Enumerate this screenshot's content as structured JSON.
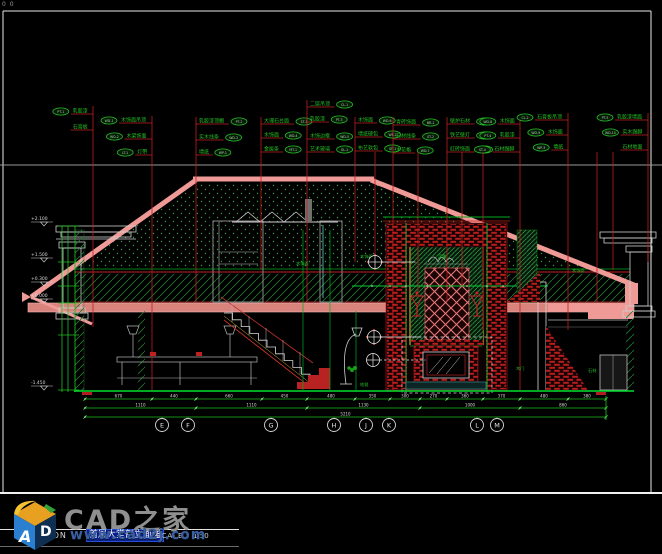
{
  "origin": "0 0",
  "colors": {
    "leader_red": "#c02020",
    "callout_green": "#25c025",
    "dim_green": "#20c020",
    "outline_pink": "#ef9a97",
    "ground_green": "#00e030",
    "white_line": "#e0e0e0"
  },
  "callouts": {
    "groups": [
      {
        "x": 93,
        "top": 106,
        "bottom": 327,
        "rows": [
          {
            "y": 112,
            "tag": "PT-1",
            "label": "乳胶漆",
            "side": "left"
          },
          {
            "y": 128,
            "tag": null,
            "label": "石膏板",
            "side": "left"
          }
        ]
      },
      {
        "x": 152,
        "top": 116,
        "bottom": 390,
        "rows": [
          {
            "y": 121,
            "tag": "WD-1",
            "label": "木饰面吊顶",
            "side": "left"
          },
          {
            "y": 137,
            "tag": "WD-2",
            "label": "木梁饰面",
            "side": "left"
          },
          {
            "y": 153,
            "tag": "LT-1",
            "label": "灯带",
            "side": "left"
          }
        ]
      },
      {
        "x": 196,
        "top": 117,
        "bottom": 302,
        "rows": [
          {
            "y": 122,
            "tag": "PT-2",
            "label": "乳胶漆顶棚",
            "side": "right"
          },
          {
            "y": 138,
            "tag": "WD-3",
            "label": "实木线条",
            "side": "right"
          },
          {
            "y": 153,
            "tag": "WP-1",
            "label": "墙纸",
            "side": "right"
          }
        ]
      },
      {
        "x": 261,
        "top": 117,
        "bottom": 270,
        "rows": [
          {
            "y": 122,
            "tag": "ST-1",
            "label": "大理石台面",
            "side": "right"
          },
          {
            "y": 136,
            "tag": "WD-4",
            "label": "木饰面",
            "side": "right"
          },
          {
            "y": 150,
            "tag": "MT-1",
            "label": "金属条",
            "side": "right"
          }
        ]
      },
      {
        "x": 307,
        "top": 100,
        "bottom": 302,
        "rows": [
          {
            "y": 105,
            "tag": "CL-1",
            "label": "二层吊顶",
            "side": "right"
          },
          {
            "y": 120,
            "tag": "PT-3",
            "label": "乳胶漆",
            "side": "right"
          },
          {
            "y": 137,
            "tag": "WD-5",
            "label": "木饰边框",
            "side": "right"
          },
          {
            "y": 150,
            "tag": "GL-1",
            "label": "艺术玻璃",
            "side": "right"
          }
        ]
      },
      {
        "x": 355,
        "top": 117,
        "bottom": 262,
        "rows": [
          {
            "y": 121,
            "tag": "WD-6",
            "label": "木饰面",
            "side": "right"
          },
          {
            "y": 135,
            "tag": "WP-2",
            "label": "墙纸硬包",
            "side": "right"
          },
          {
            "y": 149,
            "tag": "SF-1",
            "label": "布艺软包",
            "side": "right"
          }
        ]
      },
      {
        "x": 393,
        "top": 117,
        "bottom": 390,
        "rows": [
          {
            "y": 123,
            "tag": "BR-1",
            "label": "青砖饰面",
            "side": "right"
          },
          {
            "y": 137,
            "tag": "ST-2",
            "label": "石材线条",
            "side": "right"
          },
          {
            "y": 151,
            "tag": "WD-7",
            "label": "木花格",
            "side": "right"
          }
        ]
      },
      {
        "x": 447,
        "top": 117,
        "bottom": 302,
        "rows": [
          {
            "y": 122,
            "tag": "FP-1",
            "label": "壁炉石材",
            "side": "right"
          },
          {
            "y": 136,
            "tag": "MT-2",
            "label": "铁艺壁灯",
            "side": "right"
          },
          {
            "y": 150,
            "tag": "BR-2",
            "label": "红砖饰面",
            "side": "right"
          }
        ]
      },
      {
        "x": 520,
        "top": 117,
        "bottom": 390,
        "rows": [
          {
            "y": 122,
            "tag": "WD-8",
            "label": "木饰面",
            "side": "left"
          },
          {
            "y": 136,
            "tag": "PT-4",
            "label": "乳胶漆",
            "side": "left"
          },
          {
            "y": 150,
            "tag": "ST-4",
            "label": "石材踢脚",
            "side": "left"
          }
        ]
      },
      {
        "x": 568,
        "top": 113,
        "bottom": 330,
        "rows": [
          {
            "y": 118,
            "tag": "CL-2",
            "label": "石膏板吊顶",
            "side": "left"
          },
          {
            "y": 133,
            "tag": "WD-9",
            "label": "木饰面",
            "side": "left"
          },
          {
            "y": 148,
            "tag": "WP-3",
            "label": "墙纸",
            "side": "left"
          }
        ]
      },
      {
        "x": 648,
        "top": 113,
        "bottom": 262,
        "rows": [
          {
            "y": 118,
            "tag": "PT-5",
            "label": "乳胶漆墙面",
            "side": "left"
          },
          {
            "y": 133,
            "tag": "WD-10",
            "label": "实木踢脚",
            "side": "left"
          },
          {
            "y": 148,
            "tag": null,
            "label": "石材地面",
            "side": "left"
          }
        ]
      }
    ],
    "extra_leaders": [
      {
        "x": 375,
        "t": 152,
        "b": 254
      },
      {
        "x": 418,
        "t": 152,
        "b": 296
      },
      {
        "x": 462,
        "t": 152,
        "b": 286
      },
      {
        "x": 483,
        "t": 152,
        "b": 330
      },
      {
        "x": 597,
        "t": 152,
        "b": 302
      },
      {
        "x": 613,
        "t": 152,
        "b": 270
      }
    ]
  },
  "levels": [
    {
      "y": 226,
      "value": "+2.100"
    },
    {
      "y": 262,
      "value": "+1.500"
    },
    {
      "y": 286,
      "value": "+0.300"
    },
    {
      "y": 303,
      "value": "±0.000"
    },
    {
      "y": 390,
      "value": "-1.450"
    }
  ],
  "dims": {
    "rows": [
      {
        "y": 399,
        "ticks": [
          85,
          152,
          196,
          262,
          307,
          355,
          390,
          420,
          447,
          483,
          520,
          568,
          606
        ],
        "values": [
          "670",
          "440",
          "660",
          "450",
          "480",
          "350",
          "300",
          "270",
          "360",
          "370",
          "480",
          "380"
        ]
      },
      {
        "y": 408,
        "ticks": [
          85,
          196,
          307,
          420,
          520,
          606
        ],
        "values": [
          "1110",
          "1110",
          "1130",
          "1000",
          "860"
        ]
      },
      {
        "y": 417,
        "ticks": [
          85,
          606
        ],
        "values": [
          "5210"
        ]
      }
    ]
  },
  "grid": {
    "y": 425,
    "items": [
      {
        "x": 162,
        "label": "E"
      },
      {
        "x": 188,
        "label": "F"
      },
      {
        "x": 271,
        "label": "G"
      },
      {
        "x": 334,
        "label": "H"
      },
      {
        "x": 366,
        "label": "J"
      },
      {
        "x": 389,
        "label": "K"
      },
      {
        "x": 477,
        "label": "L"
      },
      {
        "x": 497,
        "label": "M"
      }
    ]
  },
  "inline_labels": [
    {
      "x": 296,
      "y": 265,
      "t": "木饰面"
    },
    {
      "x": 360,
      "y": 258,
      "t": "木饰面"
    },
    {
      "x": 572,
      "y": 272,
      "t": "木饰面"
    },
    {
      "x": 438,
      "y": 258,
      "t": "浮雕"
    },
    {
      "x": 516,
      "y": 370,
      "t": "木门"
    },
    {
      "x": 588,
      "y": 372,
      "t": "石材"
    },
    {
      "x": 360,
      "y": 386,
      "t": "地毯"
    }
  ],
  "markers": [
    {
      "x": 375,
      "y": 262,
      "diamond": true,
      "leader": 34
    },
    {
      "x": 374,
      "y": 337,
      "diamond": true,
      "leader": 40
    },
    {
      "x": 373,
      "y": 360,
      "diamond": false,
      "leader": 46
    }
  ],
  "footer": {
    "elevation": "ELEVATION",
    "title": "首层大堂剖立面图",
    "scale_label": "SCALE",
    "scale_value": "1:50"
  },
  "logo": {
    "brand": "CAD之家",
    "url": "www.cad2j.com",
    "letter_a": "A",
    "letter_d": "D"
  }
}
